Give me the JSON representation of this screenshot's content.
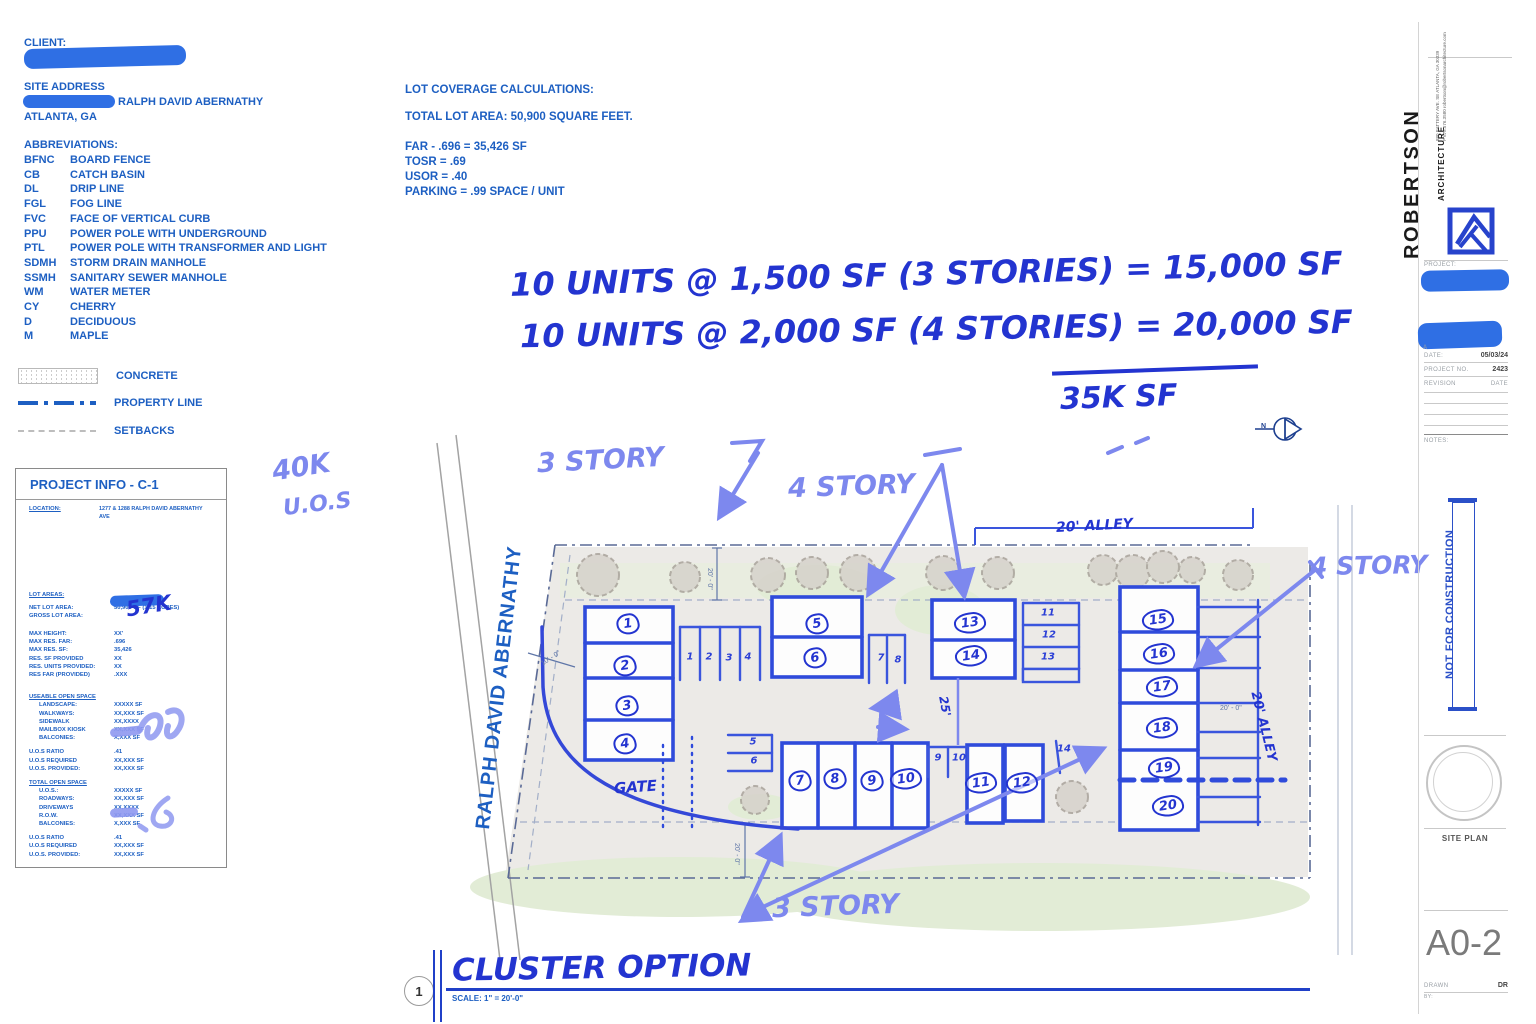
{
  "header": {
    "client_label": "CLIENT:",
    "site_address_label": "SITE ADDRESS",
    "address_visible": "RALPH DAVID ABERNATHY",
    "city": "ATLANTA, GA"
  },
  "abbreviations": {
    "title": "ABBREVIATIONS:",
    "items": [
      {
        "code": "BFNC",
        "label": "BOARD FENCE"
      },
      {
        "code": "CB",
        "label": "CATCH BASIN"
      },
      {
        "code": "DL",
        "label": "DRIP LINE"
      },
      {
        "code": "FGL",
        "label": "FOG LINE"
      },
      {
        "code": "FVC",
        "label": "FACE OF VERTICAL CURB"
      },
      {
        "code": "PPU",
        "label": "POWER POLE WITH UNDERGROUND"
      },
      {
        "code": "PTL",
        "label": "POWER POLE WITH TRANSFORMER AND LIGHT"
      },
      {
        "code": "SDMH",
        "label": "STORM DRAIN MANHOLE"
      },
      {
        "code": "SSMH",
        "label": "SANITARY SEWER MANHOLE"
      },
      {
        "code": "WM",
        "label": "WATER METER"
      },
      {
        "code": "CY",
        "label": "CHERRY"
      },
      {
        "code": "D",
        "label": "DECIDUOUS"
      },
      {
        "code": "M",
        "label": "MAPLE"
      }
    ]
  },
  "legend": {
    "concrete": "CONCRETE",
    "property_line": "PROPERTY LINE",
    "setbacks": "SETBACKS"
  },
  "lot_coverage": {
    "title": "LOT COVERAGE CALCULATIONS:",
    "total": "TOTAL LOT AREA: 50,900 SQUARE FEET.",
    "lines": [
      {
        "text": "FAR - .696 = 35,426 SF"
      },
      {
        "text": "TOSR = .69"
      },
      {
        "text": "USOR = .40"
      },
      {
        "text": "PARKING = .99 SPACE / UNIT"
      }
    ]
  },
  "hand_notes": {
    "line1": "10 UNITS @ 1,500 SF (3 STORIES) = 15,000 SF",
    "line2": "10 UNITS @ 2,000 SF (4 STORIES) = 20,000 SF",
    "sum": "35K SF",
    "uos_line1": "40K",
    "uos_line2": "U.O.S",
    "gross_note": "57K"
  },
  "project_info": {
    "title": "PROJECT INFO - C-1",
    "location_label": "LOCATION:",
    "location_value": "1277 & 1288 RALPH DAVID ABERNATHY AVE",
    "lot_areas_label": "LOT AREAS:",
    "area_rows": [
      {
        "label": "NET LOT AREA:",
        "value": "50,900 SF (1.15 ACRES)"
      },
      {
        "label": "GROSS LOT AREA:",
        "value": ""
      }
    ],
    "max_rows": [
      {
        "label": "MAX HEIGHT:",
        "value": "XX'"
      },
      {
        "label": "MAX RES. FAR:",
        "value": ".696"
      },
      {
        "label": "MAX RES. SF:",
        "value": "35,426"
      },
      {
        "label": "RES. SF PROVIDED",
        "value": "XX"
      },
      {
        "label": "RES. UNITS PROVIDED:",
        "value": "XX"
      },
      {
        "label": "RES FAR (PROVIDED)",
        "value": ".XXX"
      }
    ],
    "useable_header": "USEABLE OPEN SPACE",
    "useable_rows": [
      {
        "label": "LANDSCAPE:",
        "value": "XXXXX SF"
      },
      {
        "label": "WALKWAYS:",
        "value": "XX,XXX SF"
      },
      {
        "label": "SIDEWALK",
        "value": "XX,XXXX"
      },
      {
        "label": "MAILBOX KIOSK",
        "value": "XX,XXX SF"
      },
      {
        "label": "BALCONIES:",
        "value": "X,XXX SF"
      }
    ],
    "ratio_rows_1": [
      {
        "label": "U.O.S RATIO",
        "value": ".41"
      },
      {
        "label": "U.O.S REQUIRED",
        "value": "XX,XXX SF"
      },
      {
        "label": "U.O.S. PROVIDED:",
        "value": "XX,XXX SF"
      }
    ],
    "total_header": "TOTAL OPEN SPACE",
    "total_rows": [
      {
        "label": "U.O.S.:",
        "value": "XXXXX SF"
      },
      {
        "label": "ROADWAYS:",
        "value": "XX,XXX SF"
      },
      {
        "label": "DRIVEWAYS",
        "value": "XX,XXXX"
      },
      {
        "label": "R.O.W.",
        "value": "XX,XXX SF"
      },
      {
        "label": "BALCONIES:",
        "value": "X,XXX SF"
      }
    ],
    "ratio_rows_2": [
      {
        "label": "U.O.S RATIO",
        "value": ".41"
      },
      {
        "label": "U.O.S REQUIRED",
        "value": "XX,XXX SF"
      },
      {
        "label": "U.O.S. PROVIDED:",
        "value": "XX,XXX SF"
      }
    ]
  },
  "site_plan": {
    "street_name": "RALPH DAVID ABERNATHY",
    "labels": {
      "story3_top": "3 STORY",
      "story4_mid": "4 STORY",
      "story4_right": "4 STORY",
      "story3_bottom": "3 STORY",
      "gate": "GATE",
      "alley_top": "20' ALLEY",
      "alley_right": "20' ALLEY"
    },
    "dims": {
      "d20_top": "20' - 0\"",
      "d10_left": "10' - 0\"",
      "d20_bottom": "20' - 0\"",
      "d20_right": "20' - 0\"",
      "d25": "25'"
    },
    "north": "N",
    "units": [
      "1",
      "2",
      "3",
      "4",
      "5",
      "6",
      "7",
      "8",
      "9",
      "10",
      "11",
      "12",
      "13",
      "14",
      "15",
      "16",
      "17",
      "18",
      "19",
      "20"
    ],
    "parking": [
      "1",
      "2",
      "3",
      "4",
      "5",
      "6",
      "7",
      "8",
      "9",
      "10",
      "11",
      "12",
      "13",
      "14"
    ]
  },
  "drawing_title": {
    "number": "1",
    "title": "CLUSTER OPTION",
    "scale": "SCALE:  1\" = 20'-0\""
  },
  "title_block": {
    "firm_name": "ROBERTSON",
    "firm_sub": "ARCHITECTURE",
    "address": "880 BATTERY AVE. SE ATLANTA, GA 30339",
    "contact": "P 678.576.3580   robertson@robertsonarchitecture.com",
    "project_label": "PROJECT:",
    "visible_fragment": "A",
    "date_label": "DATE:",
    "date_value": "05/03/24",
    "project_no_label": "PROJECT NO.",
    "project_no_value": "2423",
    "revision_label": "REVISION",
    "revision_date_label": "DATE",
    "notes_label": "NOTES:",
    "stamp": "NOT FOR CONSTRUCTION",
    "sheet_title": "SITE PLAN",
    "sheet_number": "A0-2",
    "drawn_label": "DRAWN",
    "by_label": "BY:",
    "drawn_value": "DR"
  }
}
